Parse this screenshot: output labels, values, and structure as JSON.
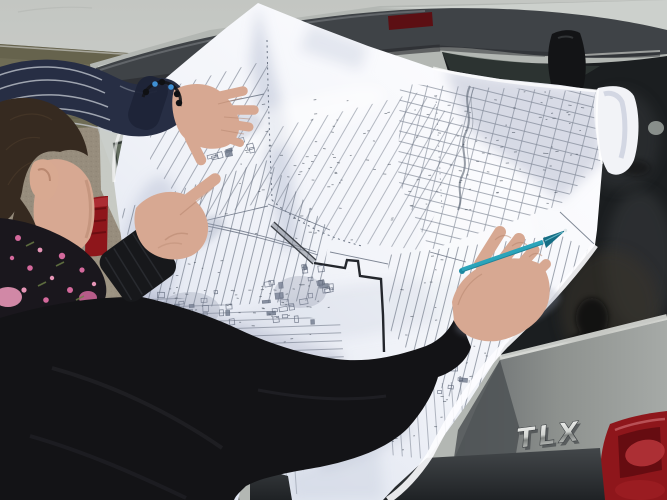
{
  "badge": {
    "text": "TLX"
  },
  "scene": {
    "description": "Two people study a large paper cadastral parcel map spread over the rear hatch of a silver car parked by an overcast field; one finger points at the map and a hand holds a teal pen."
  },
  "colors": {
    "sky": "#c6c9c5",
    "field": "#6f6c55",
    "fieldDark": "#5d5a46",
    "dirt": "#978d7d",
    "dirtLight": "#a59b8b",
    "carSilver": "#b3b7b3",
    "carSilverLight": "#ccd0cc",
    "spoiler": "#3f4347",
    "glass": "#1b1e20",
    "redLight": "#8e161b",
    "redBright": "#b43339",
    "redDark": "#5f0b0f",
    "chromeShadow": "#43474a",
    "paper": "#f6f7fb",
    "paperShade": "#b7bfd4",
    "mapLine": "#6a7383",
    "mapBold": "#23262c",
    "skin": "#d7a892",
    "skinShadow": "#b4836c",
    "hair": "#362a20",
    "sweaterBlack": "#131316",
    "sleeveNavy": "#272e44",
    "stripe": "#c8cdd5",
    "scarf": "#1a171d",
    "pink": "#d4699c",
    "pinkLight": "#e695b6",
    "penTeal": "#2ba4ba",
    "bumper": "#33373a"
  }
}
